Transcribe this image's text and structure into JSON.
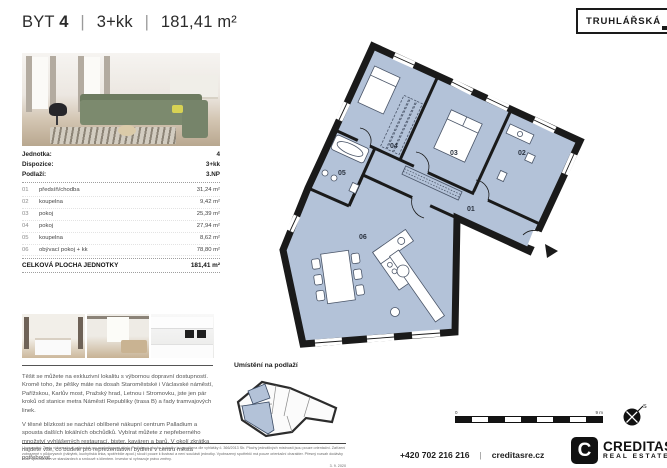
{
  "header": {
    "title_prefix": "BYT",
    "unit_number": "4",
    "separator": "|",
    "disposition": "3+kk",
    "area": "181,41 m²",
    "badge": "TRUHLÁŘSKÁ"
  },
  "unit_info": {
    "rows": [
      {
        "label": "Jednotka:",
        "value": "4"
      },
      {
        "label": "Dispozice:",
        "value": "3+kk"
      },
      {
        "label": "Podlaží:",
        "value": "3.NP"
      }
    ]
  },
  "rooms_table": {
    "rows": [
      {
        "num": "01",
        "name": "předsíň/chodba",
        "area": "31,24 m²"
      },
      {
        "num": "02",
        "name": "koupelna",
        "area": "9,42 m²"
      },
      {
        "num": "03",
        "name": "pokoj",
        "area": "25,39 m²"
      },
      {
        "num": "04",
        "name": "pokoj",
        "area": "27,94 m²"
      },
      {
        "num": "05",
        "name": "koupelna",
        "area": "8,62 m²"
      },
      {
        "num": "06",
        "name": "obývací pokoj + kk",
        "area": "78,80 m²"
      }
    ],
    "total_label": "CELKOVÁ PLOCHA JEDNOTKY",
    "total_value": "181,41 m²"
  },
  "plan": {
    "room_labels": {
      "r01": "01",
      "r02": "02",
      "r03": "03",
      "r04": "04",
      "r05": "05",
      "r06": "06"
    },
    "scale_start": "0",
    "scale_end": "9 m",
    "compass_label": "S"
  },
  "location": {
    "label": "Umístění na podlaží"
  },
  "description": {
    "p1": "Těšit se můžete na exkluzivní lokalitu s výbornou dopravní dostupností. Kromě toho, že pěšky máte na dosah Staroměstské i Václavské náměstí, Pařížskou, Karlův most, Pražský hrad, Letnou i Stromovku, jste jen pár kroků od stanice metra Náměstí Republiky (trasa B) a řady tramvajových linek.",
    "p2": "V těsné blízkosti se nachází oblíbené nákupní centrum Palladium a spousta dalších lokálních obchůdků. Vybírat můžete z nepřeberného množství vyhlášených restaurací, bister, kaváren a barů. V okolí zkrátka najdete vše, co budete pro reprezentativní bydlení v centru města potřebovat."
  },
  "disclaimer": {
    "text": "Upozornění: Tento výkres slouží výhradně pro marketingové účely. Podlahová plocha jednotky je vypočtena dle vyhlášky č. 366/2013 Sb. Plochy jednotlivých místností jsou pouze orientační. Zařízení zobrazené v půdorysech (nábytek, kuchyňská linka, spotřebiče apod.) slouží pouze k ilustraci a není součástí jednotky. Vyobrazený spotřebič má pouze orientační charakter. Přesný rozsah dodávky bude specifikován ve standardech a smlouvě s klientem. Investor si vyhrazuje právo změny.",
    "date": "3. 9. 2020"
  },
  "footer": {
    "phone": "+420 702 216 216",
    "separator": "|",
    "website": "creditasre.cz",
    "brand_letter": "C",
    "brand_name": "CREDITAS",
    "brand_sub": "REAL ESTATE"
  },
  "colors": {
    "plan_fill": "#b3c2d8",
    "wall": "#1a1a1a",
    "furniture_stroke": "#4a5568"
  }
}
